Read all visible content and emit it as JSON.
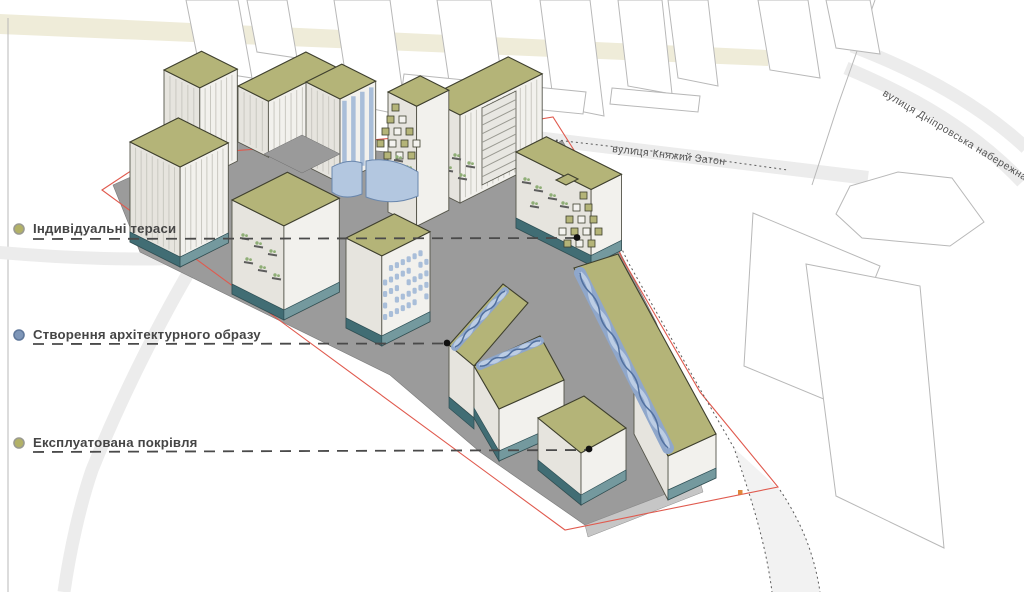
{
  "legend": {
    "items": [
      {
        "id": "individual-terraces",
        "label": "Індивідуальні тераси",
        "dot_color": "#b2b167"
      },
      {
        "id": "architectural-image",
        "label": "Створення архітектурного образу",
        "dot_color": "#7e96b8"
      },
      {
        "id": "exploited-roof",
        "label": "Експлуатована покрівля",
        "dot_color": "#b2b167"
      }
    ]
  },
  "streets": {
    "knyazhyi_zaton": "вулиця Княжий Затон",
    "dniprovska_naberezhna": "вулиця Дніпровська набережна"
  },
  "palette": {
    "roof_olive": "#b4b478",
    "roof_edge": "#3e3f2d",
    "wall_shade": "#e6e4de",
    "wall_light": "#f2f1ed",
    "stripe": "#c9c8c1",
    "blue_stripe": "#a9bed9",
    "base_teal_dark": "#416d74",
    "base_teal_light": "#74999e",
    "blue_accent": "#8fa7cb",
    "blue_deep": "#51709f",
    "blue_pale": "#bccde4",
    "ground_gray": "#9b9b9b",
    "ground_edge": "#c6c6c6",
    "road_gray": "#ececec",
    "cream_band": "#efecd9",
    "context_stroke": "#b8b8b8",
    "boundary_red": "#e05a4e",
    "dotted_line": "#5a5a5a",
    "leader_gray": "#4a4a4a",
    "label_text": "#454545",
    "plant_green": "#8fae76",
    "marker_orange": "#e0883c"
  }
}
